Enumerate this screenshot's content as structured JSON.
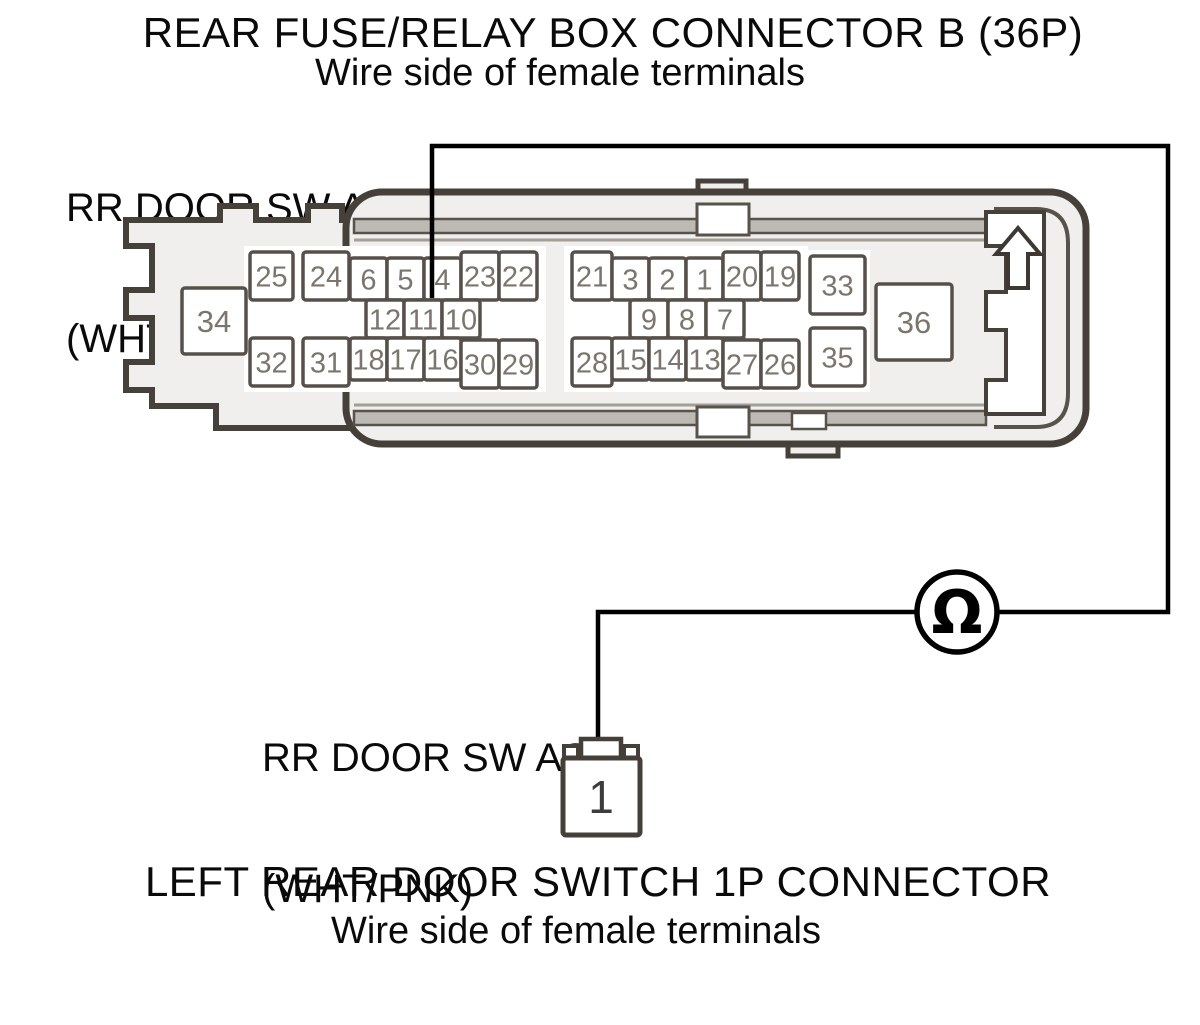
{
  "header": {
    "title": "REAR FUSE/RELAY BOX CONNECTOR B (36P)",
    "subtitle": "Wire side of female terminals"
  },
  "wire_labels": {
    "fuse_box_end": {
      "line1": "RR DOOR SW AS",
      "line2": "(WHT/PNK)"
    },
    "switch_end": {
      "line1": "RR DOOR SW AS",
      "line2": "(WHT/PNK)"
    }
  },
  "footer": {
    "title": "LEFT REAR DOOR SWITCH 1P CONNECTOR",
    "subtitle": "Wire side of female terminals"
  },
  "meter": {
    "symbol": "Ω"
  },
  "icons": {
    "direction_arrow": "up-arrow",
    "meter_circle": "ohmmeter"
  },
  "connector_36p": {
    "name": "REAR FUSE/RELAY BOX CONNECTOR B (36P)",
    "pins": [
      {
        "n": "25",
        "x": 250,
        "y": 252,
        "w": 43,
        "h": 48
      },
      {
        "n": "24",
        "x": 303,
        "y": 252,
        "w": 46,
        "h": 48
      },
      {
        "n": "6",
        "x": 350,
        "y": 258,
        "w": 37,
        "h": 42
      },
      {
        "n": "5",
        "x": 387,
        "y": 258,
        "w": 37,
        "h": 42
      },
      {
        "n": "4",
        "x": 424,
        "y": 258,
        "w": 37,
        "h": 42
      },
      {
        "n": "23",
        "x": 461,
        "y": 252,
        "w": 38,
        "h": 48
      },
      {
        "n": "22",
        "x": 499,
        "y": 252,
        "w": 38,
        "h": 48
      },
      {
        "n": "12",
        "x": 366,
        "y": 300,
        "w": 38,
        "h": 38
      },
      {
        "n": "11",
        "x": 404,
        "y": 300,
        "w": 38,
        "h": 38
      },
      {
        "n": "10",
        "x": 442,
        "y": 300,
        "w": 38,
        "h": 38
      },
      {
        "n": "32",
        "x": 250,
        "y": 338,
        "w": 43,
        "h": 48
      },
      {
        "n": "31",
        "x": 303,
        "y": 338,
        "w": 46,
        "h": 48
      },
      {
        "n": "18",
        "x": 350,
        "y": 338,
        "w": 37,
        "h": 42
      },
      {
        "n": "17",
        "x": 387,
        "y": 338,
        "w": 37,
        "h": 42
      },
      {
        "n": "16",
        "x": 424,
        "y": 338,
        "w": 37,
        "h": 42
      },
      {
        "n": "30",
        "x": 461,
        "y": 340,
        "w": 38,
        "h": 48
      },
      {
        "n": "29",
        "x": 499,
        "y": 340,
        "w": 38,
        "h": 48
      },
      {
        "n": "21",
        "x": 572,
        "y": 252,
        "w": 40,
        "h": 48
      },
      {
        "n": "3",
        "x": 612,
        "y": 258,
        "w": 37,
        "h": 42
      },
      {
        "n": "2",
        "x": 649,
        "y": 258,
        "w": 37,
        "h": 42
      },
      {
        "n": "1",
        "x": 686,
        "y": 258,
        "w": 37,
        "h": 42
      },
      {
        "n": "20",
        "x": 723,
        "y": 252,
        "w": 38,
        "h": 48
      },
      {
        "n": "19",
        "x": 761,
        "y": 252,
        "w": 38,
        "h": 48
      },
      {
        "n": "9",
        "x": 630,
        "y": 300,
        "w": 38,
        "h": 38
      },
      {
        "n": "8",
        "x": 668,
        "y": 300,
        "w": 38,
        "h": 38
      },
      {
        "n": "7",
        "x": 706,
        "y": 300,
        "w": 38,
        "h": 38
      },
      {
        "n": "28",
        "x": 572,
        "y": 338,
        "w": 40,
        "h": 48
      },
      {
        "n": "15",
        "x": 612,
        "y": 338,
        "w": 37,
        "h": 42
      },
      {
        "n": "14",
        "x": 649,
        "y": 338,
        "w": 37,
        "h": 42
      },
      {
        "n": "13",
        "x": 686,
        "y": 338,
        "w": 37,
        "h": 42
      },
      {
        "n": "27",
        "x": 723,
        "y": 340,
        "w": 38,
        "h": 48
      },
      {
        "n": "26",
        "x": 761,
        "y": 340,
        "w": 38,
        "h": 48
      },
      {
        "n": "33",
        "x": 810,
        "y": 256,
        "w": 55,
        "h": 58
      },
      {
        "n": "35",
        "x": 810,
        "y": 328,
        "w": 55,
        "h": 58
      },
      {
        "n": "34",
        "x": 182,
        "y": 288,
        "w": 64,
        "h": 66
      },
      {
        "n": "36",
        "x": 876,
        "y": 284,
        "w": 76,
        "h": 76
      }
    ]
  },
  "connector_1p": {
    "name": "LEFT REAR DOOR SWITCH 1P CONNECTOR",
    "pin": "1"
  },
  "colors": {
    "outline": "#46403a",
    "inner_wall": "#58524c",
    "pin_border": "#57504a",
    "pin_number": "#7b756e",
    "housing_fill": "#f0efed",
    "band_fill": "#bdb9b5",
    "wire": "#000000",
    "text": "#0a0a0a"
  }
}
